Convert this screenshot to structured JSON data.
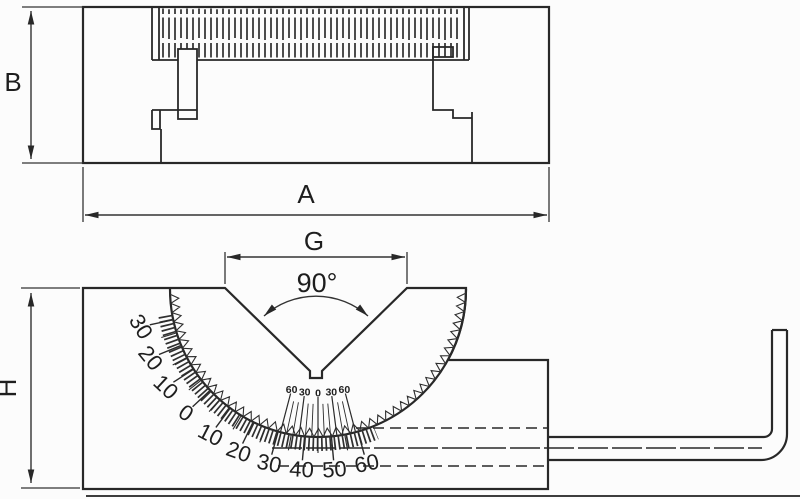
{
  "labels": {
    "width": "A",
    "height": "B",
    "groove_width": "G",
    "block_height": "H",
    "groove_angle": "90°"
  },
  "protractor": {
    "scale_labels": [
      "30",
      "20",
      "10",
      "0",
      "10",
      "20",
      "30",
      "40",
      "50",
      "60"
    ],
    "scale_angles_deg": [
      168,
      157.6,
      147.2,
      136.8,
      126.4,
      116,
      105.6,
      95.2,
      84.8,
      74.4
    ],
    "vernier_labels": [
      "60",
      "30",
      "0",
      "30",
      "60"
    ],
    "vernier_angles_deg": [
      104.7,
      97.35,
      90,
      82.65,
      75.3
    ]
  },
  "colors": {
    "ink": "#282828",
    "paper": "#fcfcfc"
  }
}
